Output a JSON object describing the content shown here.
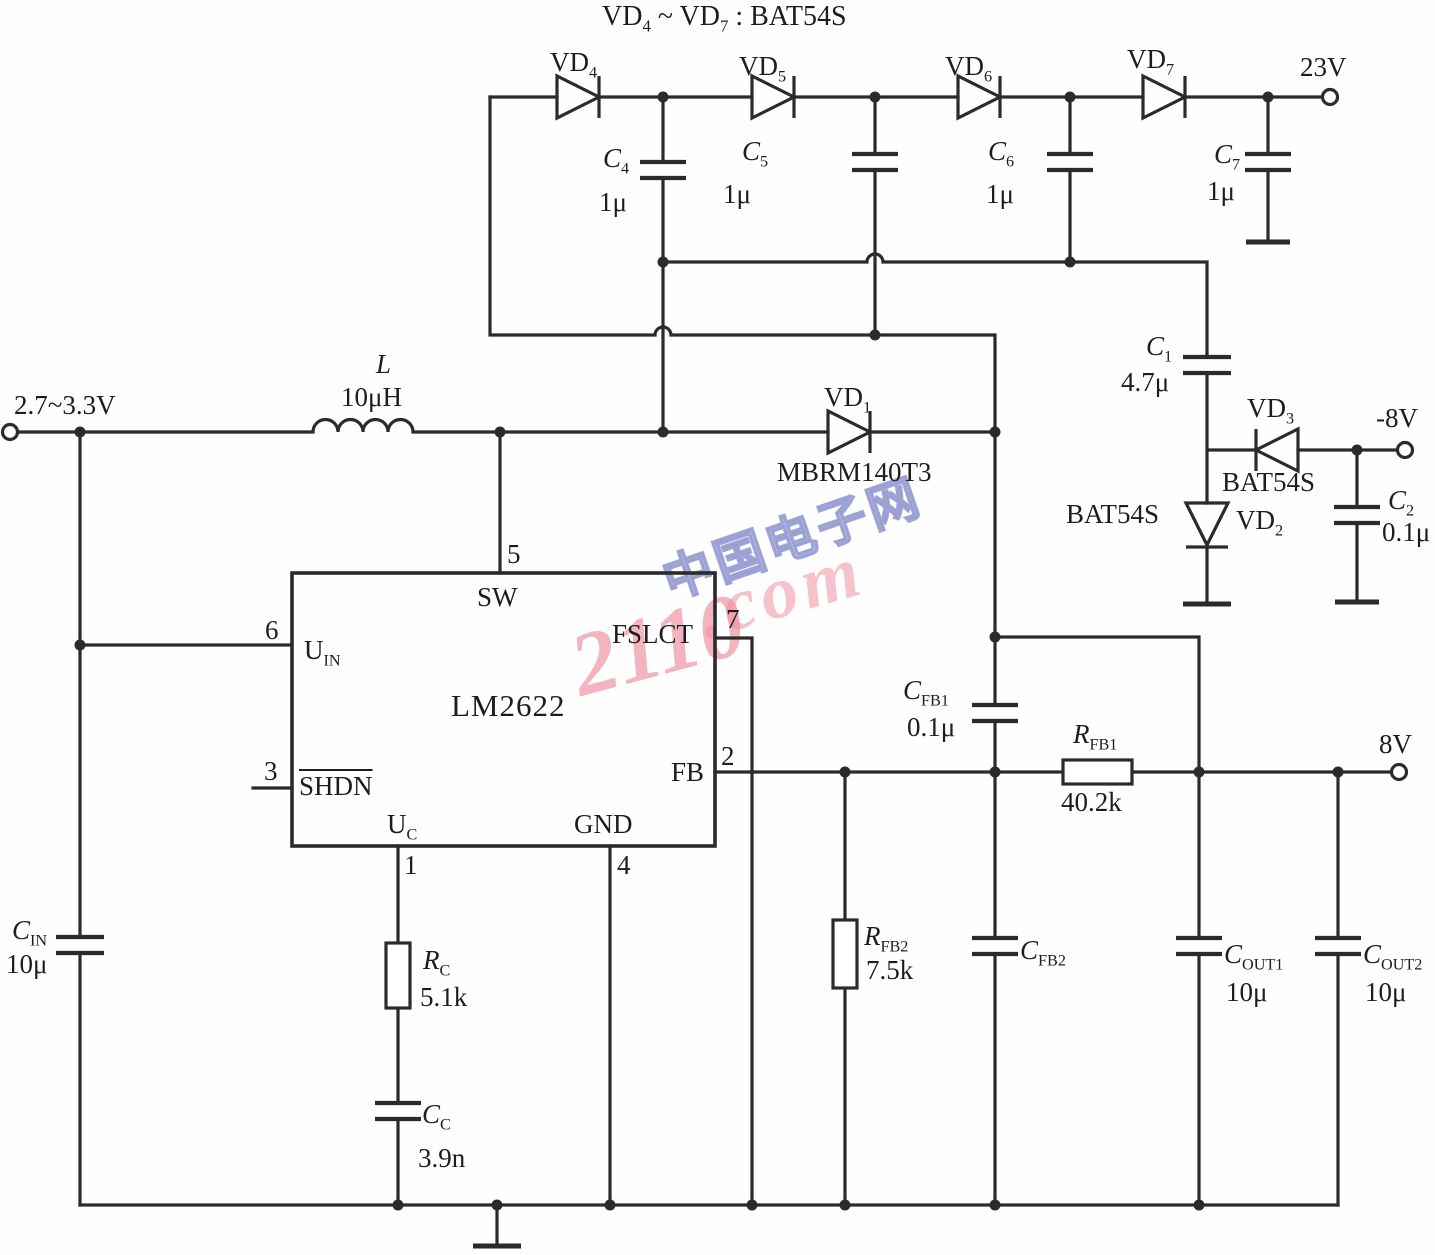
{
  "title": {
    "p1": "VD",
    "s1": "4",
    "p2": " ~ VD",
    "s2": "7",
    "p3": " : BAT54S"
  },
  "terminals": {
    "input": "2.7~3.3V",
    "out23": "23V",
    "outneg8": "-8V",
    "out8": "8V"
  },
  "inductor": {
    "ref": "L",
    "value": "10μH"
  },
  "ic": {
    "name": "LM2622",
    "pins": {
      "sw": {
        "num": "5",
        "label": "SW"
      },
      "uin": {
        "num": "6",
        "label": "U",
        "sub": "IN"
      },
      "shdn": {
        "num": "3",
        "label": "SHDN"
      },
      "uc": {
        "num": "1",
        "label": "U",
        "sub": "C"
      },
      "gnd": {
        "num": "4",
        "label": "GND"
      },
      "fslct": {
        "num": "7",
        "label": "FSLCT"
      },
      "fb": {
        "num": "2",
        "label": "FB"
      }
    }
  },
  "diodes": {
    "vd1": {
      "ref": "VD",
      "sub": "1",
      "part": "MBRM140T3"
    },
    "vd2": {
      "ref": "VD",
      "sub": "2",
      "part": "BAT54S"
    },
    "vd3": {
      "ref": "VD",
      "sub": "3",
      "part": "BAT54S"
    },
    "vd4": {
      "ref": "VD",
      "sub": "4"
    },
    "vd5": {
      "ref": "VD",
      "sub": "5"
    },
    "vd6": {
      "ref": "VD",
      "sub": "6"
    },
    "vd7": {
      "ref": "VD",
      "sub": "7"
    }
  },
  "capacitors": {
    "c1": {
      "ref": "C",
      "sub": "1",
      "value": "4.7μ"
    },
    "c2": {
      "ref": "C",
      "sub": "2",
      "value": "0.1μ"
    },
    "c4": {
      "ref": "C",
      "sub": "4",
      "value": "1μ"
    },
    "c5": {
      "ref": "C",
      "sub": "5",
      "value": "1μ"
    },
    "c6": {
      "ref": "C",
      "sub": "6",
      "value": "1μ"
    },
    "c7": {
      "ref": "C",
      "sub": "7",
      "value": "1μ"
    },
    "cin": {
      "ref": "C",
      "sub": "IN",
      "value": "10μ"
    },
    "cc": {
      "ref": "C",
      "sub": "C",
      "value": "3.9n"
    },
    "cfb1": {
      "ref": "C",
      "sub": "FB1",
      "value": "0.1μ"
    },
    "cfb2": {
      "ref": "C",
      "sub": "FB2",
      "value": ""
    },
    "cout1": {
      "ref": "C",
      "sub": "OUT1",
      "value": "10μ"
    },
    "cout2": {
      "ref": "C",
      "sub": "OUT2",
      "value": "10μ"
    }
  },
  "resistors": {
    "rc": {
      "ref": "R",
      "sub": "C",
      "value": "5.1k"
    },
    "rfb1": {
      "ref": "R",
      "sub": "FB1",
      "value": "40.2k"
    },
    "rfb2": {
      "ref": "R",
      "sub": "FB2",
      "value": "7.5k"
    }
  },
  "watermark": {
    "cn": "中国电子网",
    "num": "2110",
    "dom": ".com"
  },
  "colors": {
    "line": "#2b2b2b",
    "watermark_pink": "#ee8fa0",
    "watermark_blue": "#8f97cf"
  }
}
